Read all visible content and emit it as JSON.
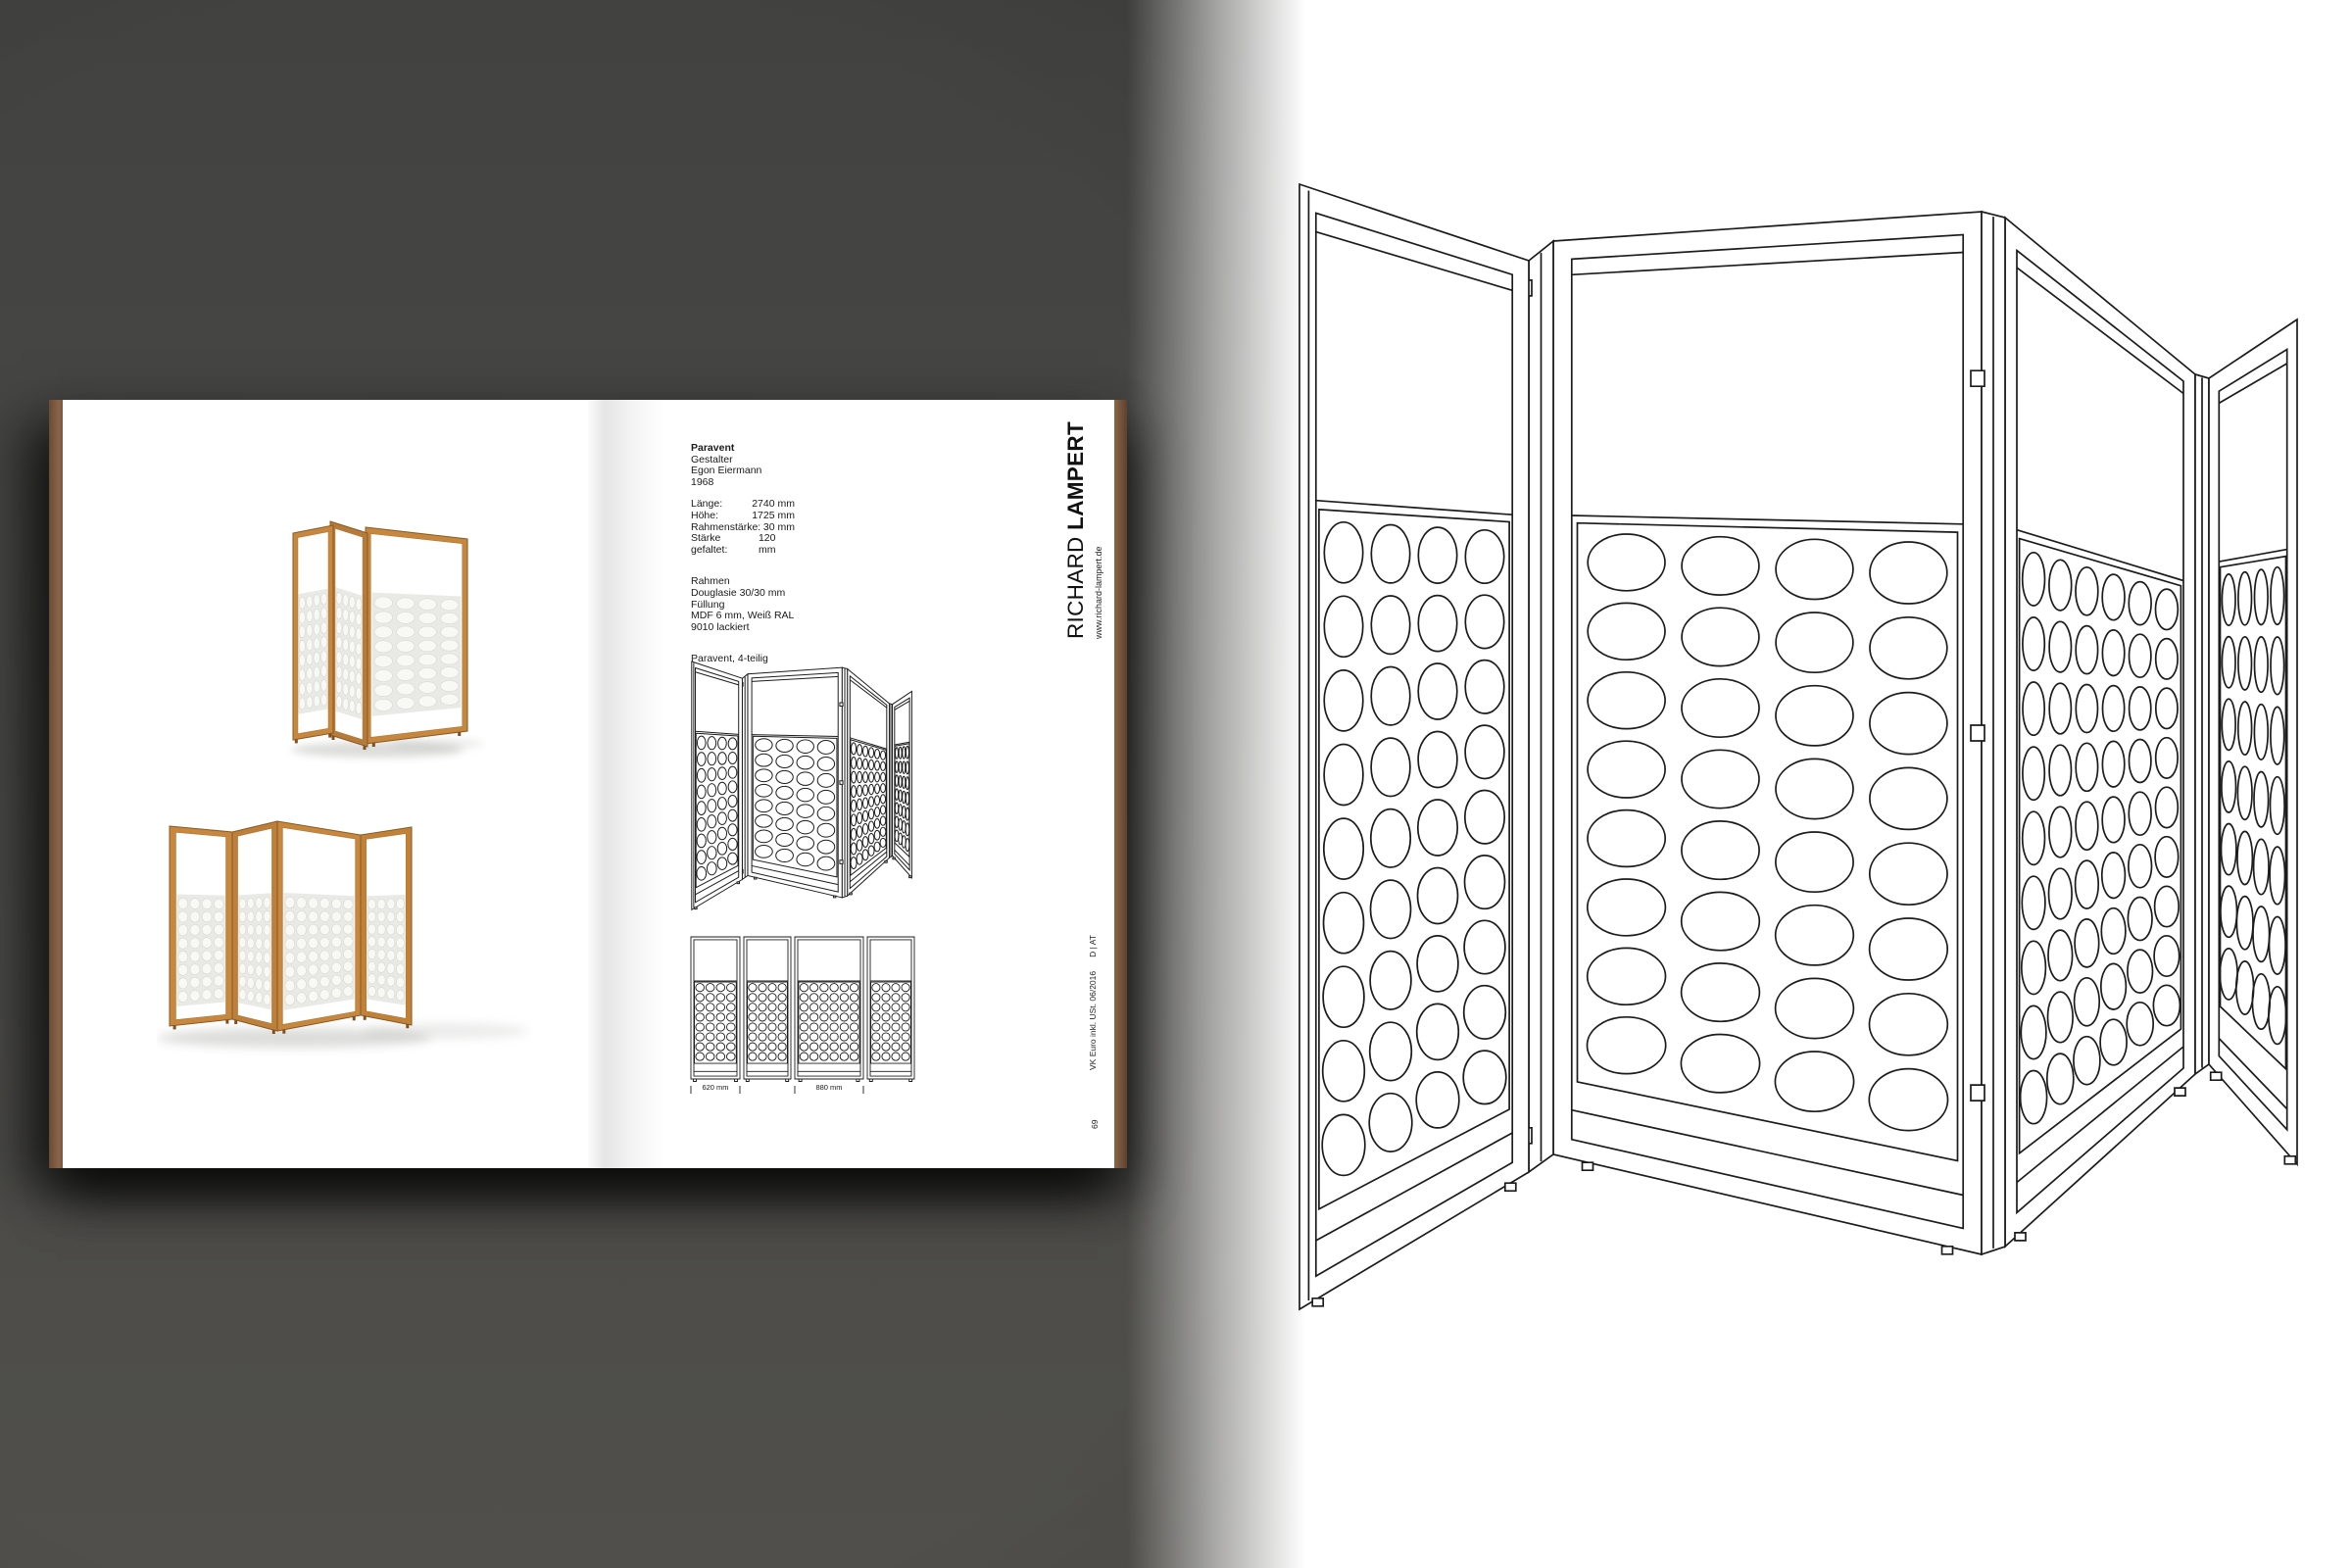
{
  "catalog_page": {
    "product": {
      "name": "Paravent",
      "designer_label": "Gestalter",
      "designer": "Egon Eiermann",
      "year": "1968"
    },
    "specs": [
      {
        "label": "Länge:",
        "value": "2740 mm"
      },
      {
        "label": "Höhe:",
        "value": "1725 mm"
      },
      {
        "label": "Rahmenstärke:",
        "value": "30 mm"
      },
      {
        "label": "Stärke gefaltet:",
        "value": "120 mm"
      }
    ],
    "materials": [
      "Rahmen",
      "Douglasie 30/30 mm",
      "Füllung",
      "MDF 6 mm, Weiß RAL 9010 lackiert"
    ],
    "variant_label": "Paravent, 4-teilig",
    "brand": {
      "name_regular": "RICHARD",
      "name_bold": "LAMPERT",
      "website": "www.richard-lampert.de"
    },
    "footer": {
      "price_note": "VK Euro inkl. USt. 06/2016",
      "region": "D | AT",
      "page_number": "69"
    },
    "dimensions": {
      "panel_1": "620 mm",
      "panel_3": "880 mm"
    }
  },
  "colors": {
    "backdrop": "#484846",
    "book_cover": "#7d5a40",
    "wood": "#c6873f",
    "ink": "#1c1c1c",
    "page": "#ffffff"
  }
}
